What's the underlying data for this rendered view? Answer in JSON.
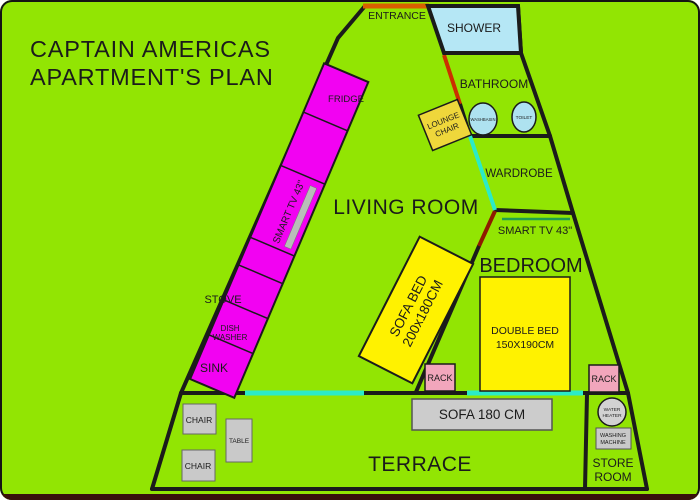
{
  "title": {
    "line1": "CAPTAIN AMERICAS",
    "line2": "APARTMENT'S PLAN"
  },
  "rooms": {
    "entrance": "ENTRANCE",
    "shower": "SHOWER",
    "bathroom": "BATHROOM",
    "wardrobe": "WARDROBE",
    "living_room": "LIVING ROOM",
    "bedroom": "BEDROOM",
    "terrace": "TERRACE",
    "store_room": {
      "line1": "STORE",
      "line2": "ROOM"
    }
  },
  "kitchen": {
    "fridge": "FRIDGE",
    "smart_tv": "SMART TV 43\"",
    "stove": "STOVE",
    "dish_washer": {
      "line1": "DISH",
      "line2": "WASHER"
    },
    "sink": "SINK"
  },
  "bathroom_fixtures": {
    "washbasin": "WASHBASIN",
    "toilet": "TOILET",
    "lounge_chair": {
      "line1": "LOUNGE",
      "line2": "CHAIR"
    }
  },
  "bedroom_items": {
    "smart_tv": "SMART TV 43\"",
    "double_bed": {
      "line1": "DOUBLE BED",
      "line2": "150X190CM"
    },
    "sofa_bed": {
      "line1": "SOFA BED",
      "line2": "200x180CM"
    },
    "rack_left": "RACK",
    "rack_right": "RACK"
  },
  "terrace_items": {
    "sofa": "SOFA 180 CM",
    "chair_top": "CHAIR",
    "table": "TABLE",
    "chair_bottom": "CHAIR",
    "water_heater": {
      "line1": "WATER",
      "line2": "HEATER"
    },
    "washing_machine": {
      "line1": "WASHING",
      "line2": "MACHINE"
    }
  },
  "colors": {
    "background": "#92E503",
    "wall_black": "#1B1B1B",
    "kitchen_counter_magenta": "#F202F2",
    "shower_light_blue": "#B5E7F5",
    "window_teal": "#2BEBC8",
    "furniture_yellow": "#FFF200",
    "lounge_chair_yellow": "#EFD73B",
    "rack_pink": "#F2A6BC",
    "furniture_gray": "#C9C9C9",
    "entrance_door_orange": "#D95F00",
    "bathroom_door_red": "#CC2E00",
    "bedroom_door_dark_red": "#8F1A00",
    "tv_wall_line_green": "#1F9E50",
    "bottom_strip_maroon": "#38100C"
  }
}
